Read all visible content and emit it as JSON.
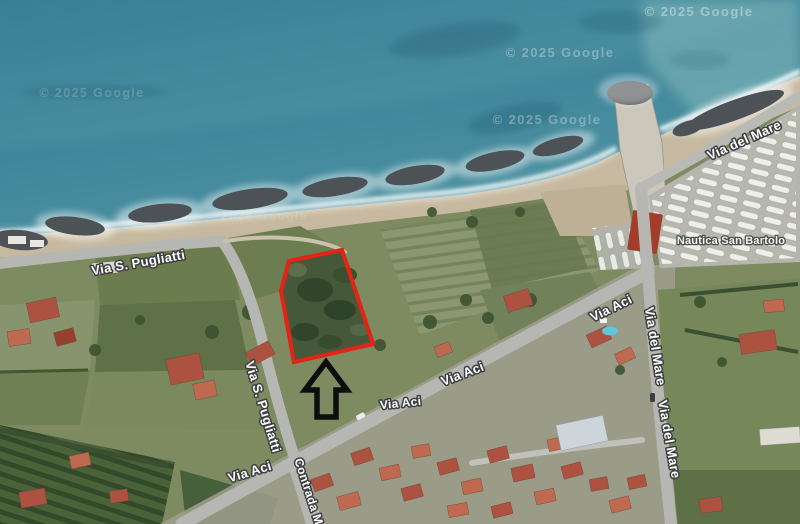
{
  "map": {
    "attribution_text": "© 2025 Google",
    "watermarks": [
      {
        "x": 92,
        "y": 97,
        "size": 12.5,
        "opacity": 0.22
      },
      {
        "x": 560,
        "y": 57,
        "size": 13,
        "opacity": 0.38
      },
      {
        "x": 699,
        "y": 16,
        "size": 13,
        "opacity": 0.48
      },
      {
        "x": 547,
        "y": 124,
        "size": 13,
        "opacity": 0.36
      },
      {
        "x": 257,
        "y": 220,
        "size": 12,
        "opacity": 0.16
      }
    ],
    "street_labels": [
      {
        "text": "Via S. Pugliatti",
        "x": 139,
        "y": 267,
        "rotate": -10,
        "size": 13
      },
      {
        "text": "Via S. Pugliatti",
        "x": 259,
        "y": 408,
        "rotate": 73,
        "size": 13
      },
      {
        "text": "Via Aci",
        "x": 251,
        "y": 476,
        "rotate": -17,
        "size": 13
      },
      {
        "text": "Via Aci",
        "x": 401,
        "y": 407,
        "rotate": -6,
        "size": 12
      },
      {
        "text": "Via Aci",
        "x": 464,
        "y": 378,
        "rotate": -21,
        "size": 13
      },
      {
        "text": "Via Aci",
        "x": 613,
        "y": 312,
        "rotate": -26,
        "size": 13
      },
      {
        "text": "Via del Mare",
        "x": 746,
        "y": 144,
        "rotate": -24,
        "size": 13
      },
      {
        "text": "Via del Mare",
        "x": 651,
        "y": 347,
        "rotate": 81,
        "size": 13
      },
      {
        "text": "Via del Mare",
        "x": 665,
        "y": 440,
        "rotate": 80,
        "size": 13
      },
      {
        "text": "Contrada Ma",
        "x": 306,
        "y": 496,
        "rotate": 72,
        "size": 12
      }
    ],
    "poi_labels": [
      {
        "text": "Nautica San Bartolo",
        "x": 731,
        "y": 244,
        "size": 11
      }
    ],
    "parcel": {
      "color": "#e02418",
      "stroke_width": 4.2,
      "points": "342,250 373,344 294,362 281,291 289,261"
    },
    "arrow": {
      "color": "#0d0d0d",
      "stroke_width": 5.5,
      "points": "326,362 347,390 336,390 336,417 317,417 317,390 305,390"
    }
  }
}
